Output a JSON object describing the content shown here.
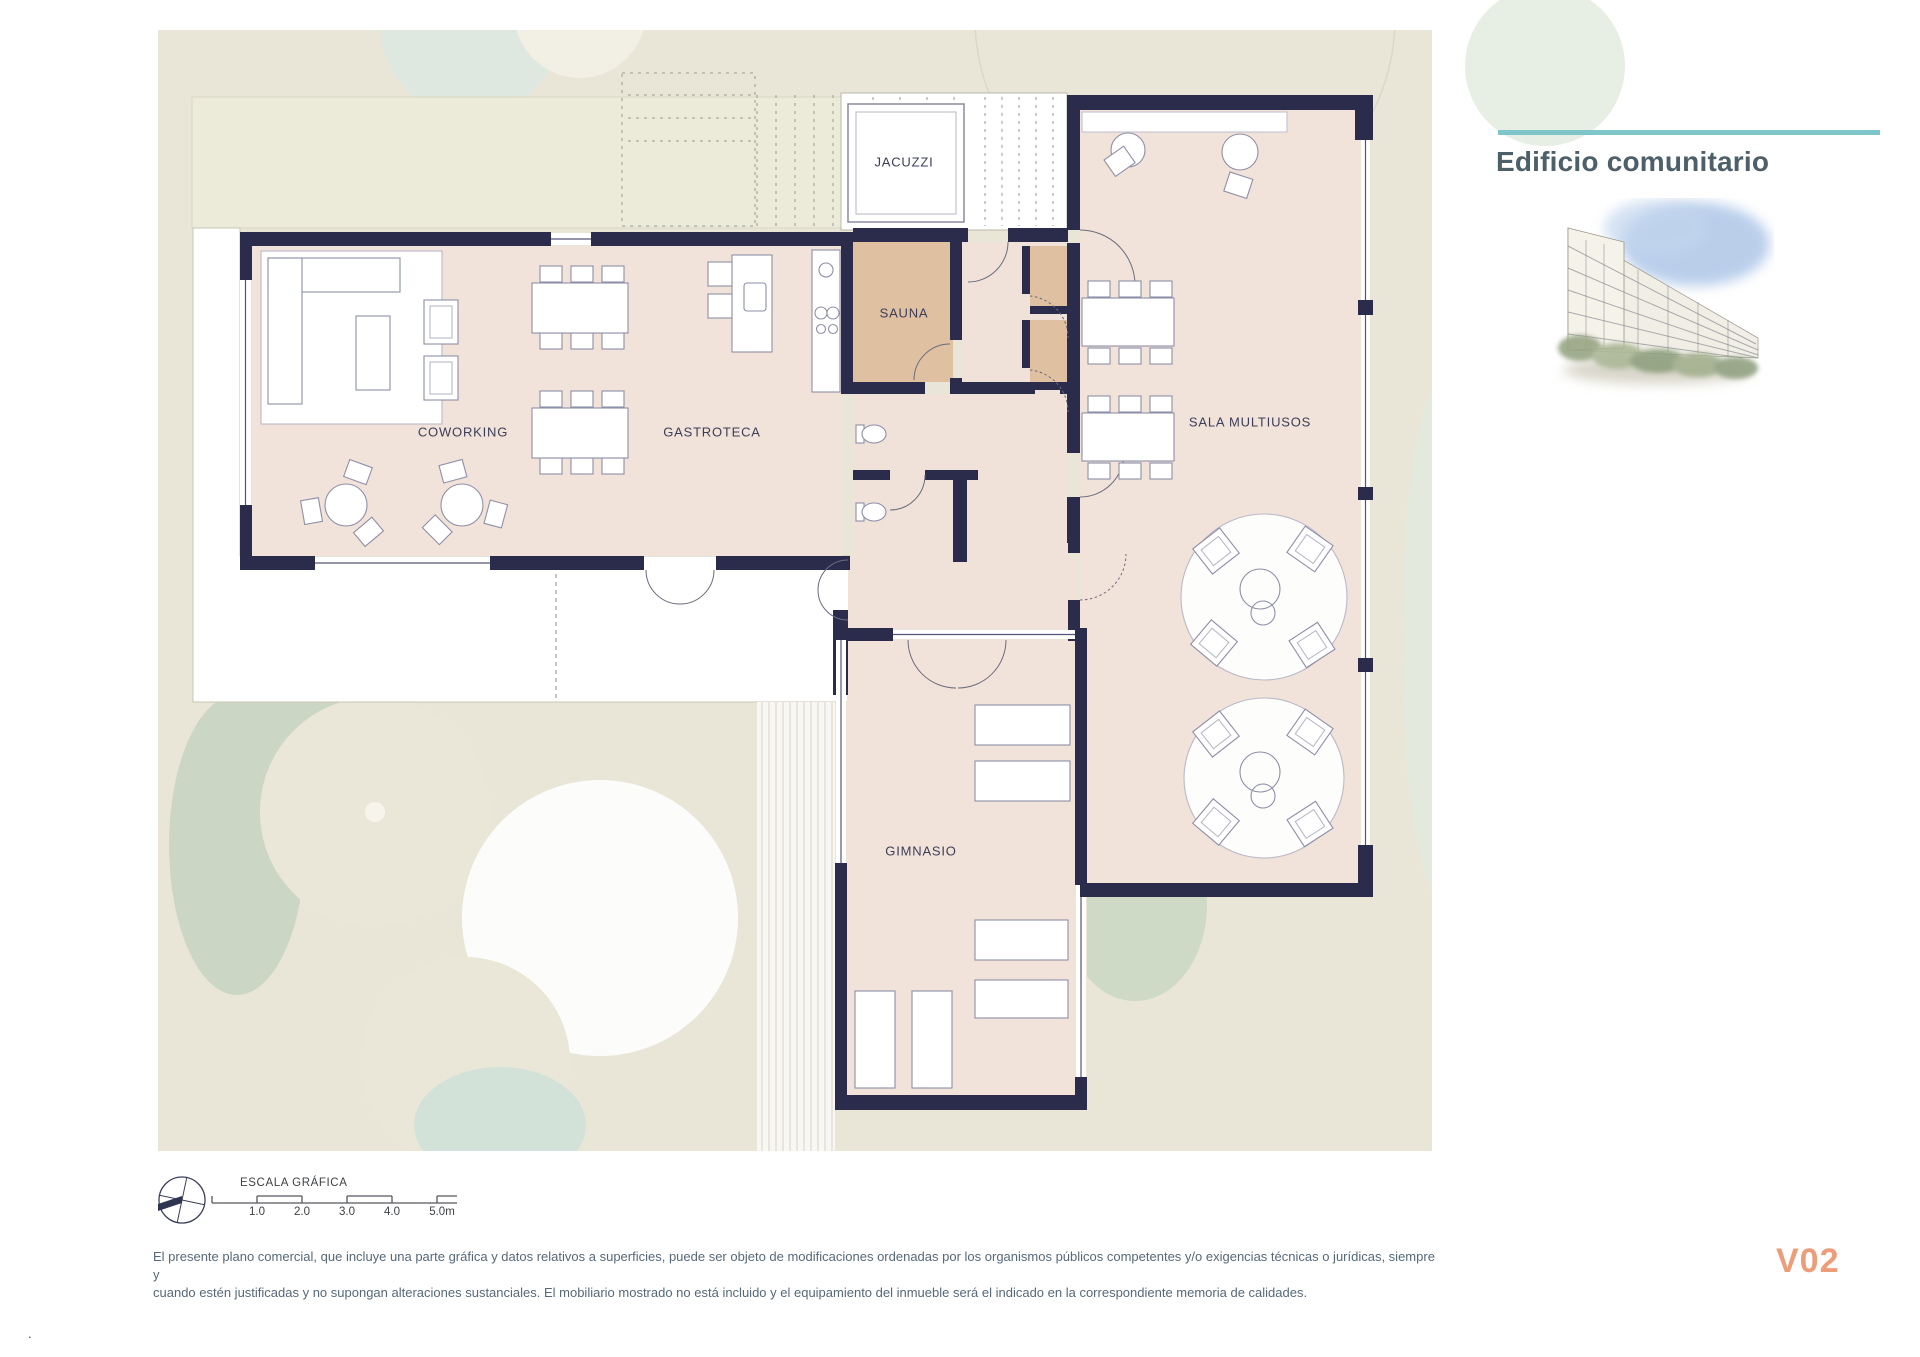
{
  "page": {
    "corner_mark": "."
  },
  "plan": {
    "rooms": [
      {
        "id": "coworking",
        "label": "COWORKING"
      },
      {
        "id": "gastroteca",
        "label": "GASTROTECA"
      },
      {
        "id": "jacuzzi",
        "label": "JACUZZI"
      },
      {
        "id": "sauna",
        "label": "SAUNA"
      },
      {
        "id": "sala_multiusos",
        "label": "SALA MULTIUSOS"
      },
      {
        "id": "gimnasio",
        "label": "GIMNASIO"
      }
    ]
  },
  "side_panel": {
    "title": "Edificio comunitario"
  },
  "scale_bar": {
    "title": "ESCALA GRÁFICA",
    "ticks": [
      "1.0",
      "2.0",
      "3.0",
      "4.0",
      "5.0m"
    ]
  },
  "footer": {
    "disclaimer_line1": "El presente plano comercial, que incluye una parte gráfica y datos relativos a superficies, puede ser objeto de modificaciones ordenadas por los organismos públicos competentes y/o exigencias técnicas o jurídicas, siempre y",
    "disclaimer_line2": "cuando estén justificadas y no supongan alteraciones sustanciales. El mobiliario mostrado no está incluido y el equipamiento del inmueble será el indicado en la correspondiente memoria de calidades.",
    "version": "V02"
  },
  "colors": {
    "accent_teal": "#7ec6ca",
    "version_orange": "#ed9d79",
    "wall_navy": "#2b2c4c",
    "floor_pink": "#f2e3da",
    "sauna_tan": "#dfc0a1",
    "plan_background": "#e9e6d7",
    "title_color": "#4d5f68"
  }
}
